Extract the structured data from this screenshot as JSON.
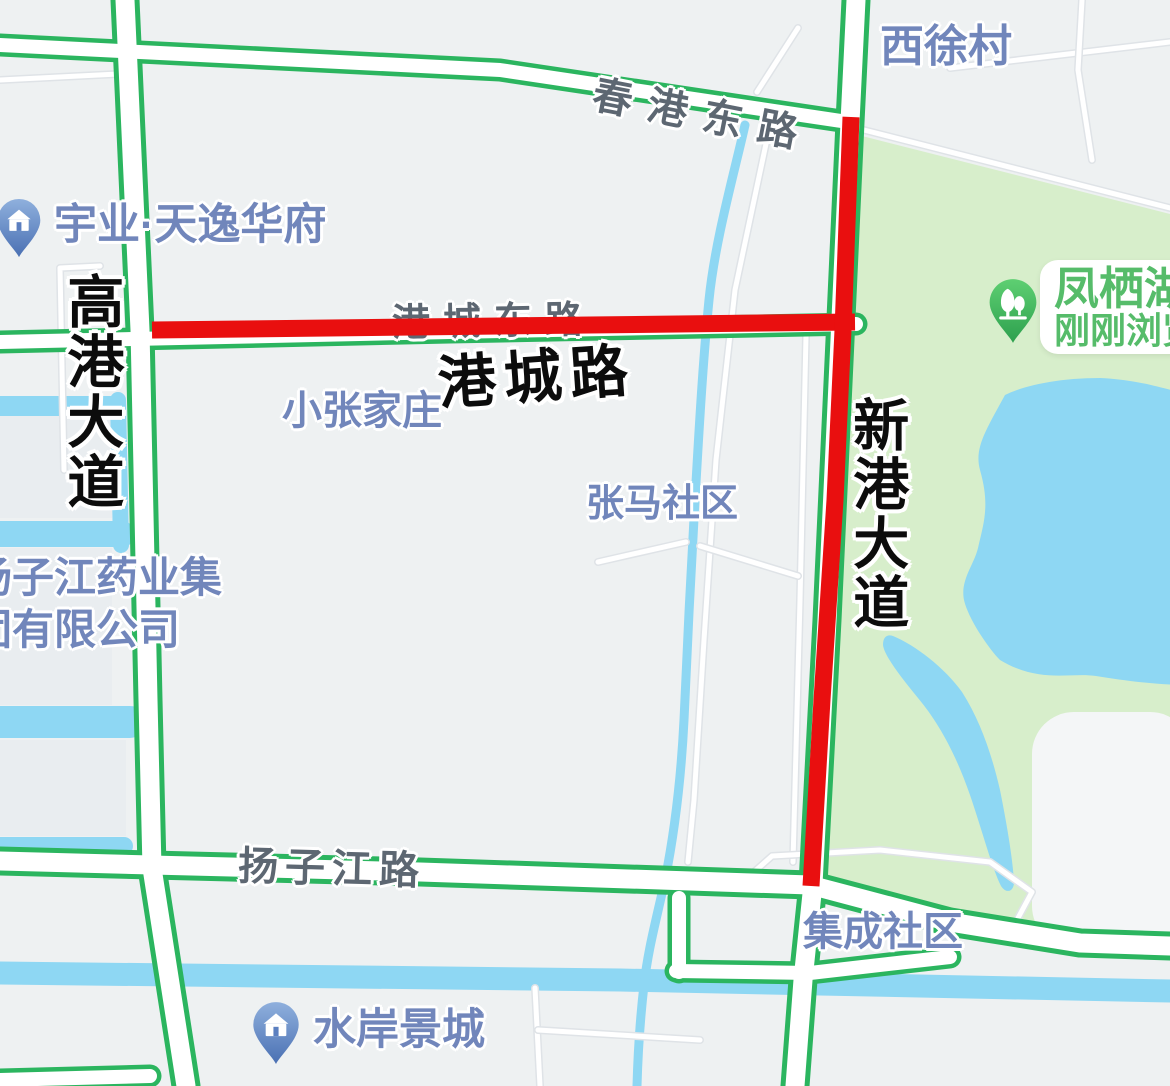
{
  "map": {
    "roads": {
      "chungang_east_label": "春港东路",
      "gangcheng_east_label": "港城东路",
      "gangcheng_big_label": "港城路",
      "gaogang_avenue_label": "高港大道",
      "xingang_avenue_label": "新港大道",
      "yangzijiang_road_label": "扬子江路"
    },
    "places": {
      "xixu_village": "西徐村",
      "yuye_tianyi_huafu": "宇业·天逸华府",
      "xiaozhangjiazhuang": "小张家庄",
      "zhangma_community": "张马社区",
      "jicheng_community": "集成社区",
      "shuian_jingcheng": "水岸景城",
      "pharma_line1": "扬子江药业集",
      "pharma_line2": "团有限公司"
    },
    "poi_card": {
      "line1": "凤栖湖",
      "line2": "刚刚浏览"
    },
    "colors": {
      "background": "#eef1f2",
      "park": "#d7eecb",
      "water": "#8ed7f3",
      "road_green": "#2bb55f",
      "route_red": "#e90f0f",
      "road_label": "#5d6772",
      "place_label": "#7186bb",
      "poi_green": "#56bc6a"
    }
  }
}
